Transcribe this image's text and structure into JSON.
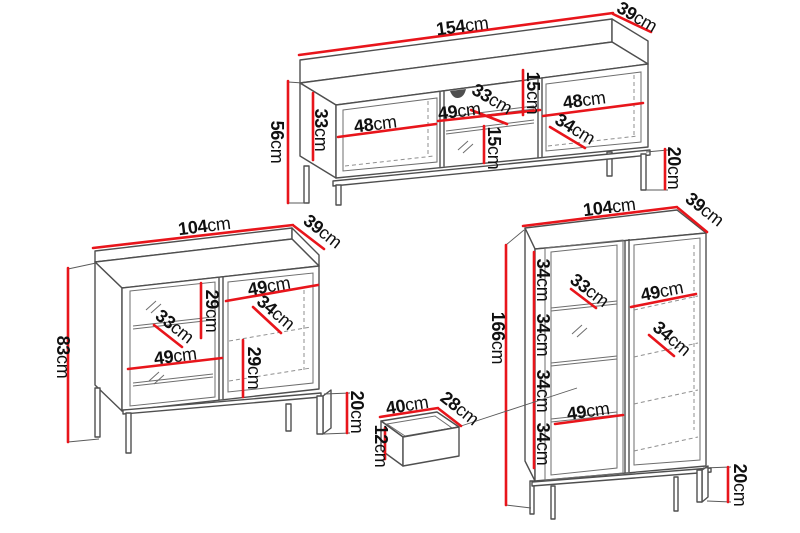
{
  "diagram": {
    "kind": "furniture-dimension-drawing",
    "background": "#ffffff"
  },
  "colors": {
    "dimension_line": "#e8151b",
    "outline": "#4f4f4f",
    "label_text": "#101010"
  },
  "pieces": {
    "tv_stand": {
      "dims": {
        "width": {
          "v": "154",
          "u": "cm"
        },
        "depth": {
          "v": "39",
          "u": "cm"
        },
        "height": {
          "v": "56",
          "u": "cm"
        },
        "left_opening_height": {
          "v": "33",
          "u": "cm"
        },
        "left_opening_width": {
          "v": "48",
          "u": "cm"
        },
        "middle_opening_width": {
          "v": "49",
          "u": "cm"
        },
        "middle_opening_depth": {
          "v": "33",
          "u": "cm"
        },
        "top_shelf_height": {
          "v": "15",
          "u": "cm"
        },
        "lower_shelf_height": {
          "v": "15",
          "u": "cm"
        },
        "right_opening_width": {
          "v": "48",
          "u": "cm"
        },
        "right_opening_depth": {
          "v": "34",
          "u": "cm"
        },
        "leg_height": {
          "v": "20",
          "u": "cm"
        }
      }
    },
    "sideboard": {
      "dims": {
        "width": {
          "v": "104",
          "u": "cm"
        },
        "depth": {
          "v": "39",
          "u": "cm"
        },
        "height": {
          "v": "83",
          "u": "cm"
        },
        "upper_shelf_height": {
          "v": "29",
          "u": "cm"
        },
        "left_opening_depth": {
          "v": "33",
          "u": "cm"
        },
        "left_opening_width": {
          "v": "49",
          "u": "cm"
        },
        "right_opening_width": {
          "v": "49",
          "u": "cm"
        },
        "right_opening_depth": {
          "v": "34",
          "u": "cm"
        },
        "lower_shelf_height": {
          "v": "29",
          "u": "cm"
        },
        "leg_height": {
          "v": "20",
          "u": "cm"
        }
      }
    },
    "display_cabinet": {
      "dims": {
        "width": {
          "v": "104",
          "u": "cm"
        },
        "depth": {
          "v": "39",
          "u": "cm"
        },
        "height": {
          "v": "166",
          "u": "cm"
        },
        "shelf_spacing_1": {
          "v": "34",
          "u": "cm"
        },
        "shelf_spacing_2": {
          "v": "34",
          "u": "cm"
        },
        "shelf_spacing_3": {
          "v": "34",
          "u": "cm"
        },
        "shelf_spacing_4": {
          "v": "34",
          "u": "cm"
        },
        "left_opening_depth": {
          "v": "33",
          "u": "cm"
        },
        "right_opening_width": {
          "v": "49",
          "u": "cm"
        },
        "right_opening_depth": {
          "v": "34",
          "u": "cm"
        },
        "left_opening_width": {
          "v": "49",
          "u": "cm"
        },
        "leg_height": {
          "v": "20",
          "u": "cm"
        }
      }
    },
    "drawer": {
      "dims": {
        "width": {
          "v": "40",
          "u": "cm"
        },
        "depth": {
          "v": "28",
          "u": "cm"
        },
        "height": {
          "v": "12",
          "u": "cm"
        }
      }
    }
  }
}
